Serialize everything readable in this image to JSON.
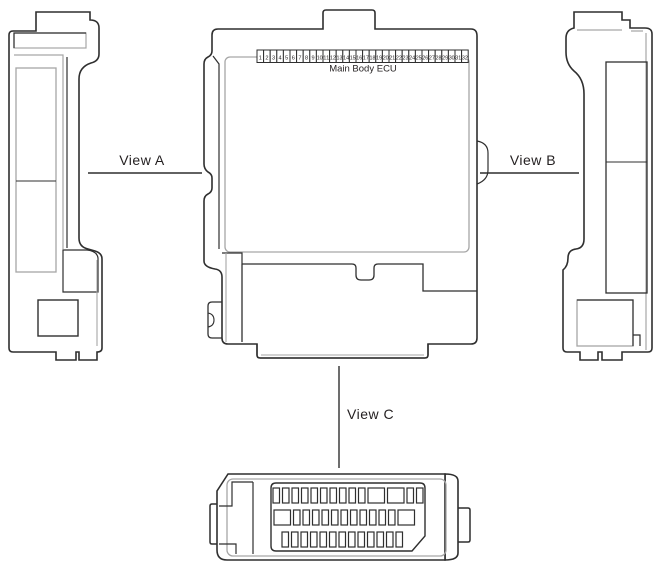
{
  "diagram": {
    "component_name": "Main Body ECU",
    "views": {
      "a": "View A",
      "b": "View B",
      "c": "View C"
    },
    "top_connector": {
      "pin_count": 32,
      "pin_numbers": [
        "1",
        "2",
        "3",
        "4",
        "5",
        "6",
        "7",
        "8",
        "9",
        "10",
        "11",
        "12",
        "13",
        "14",
        "15",
        "16",
        "17",
        "18",
        "19",
        "20",
        "21",
        "22",
        "23",
        "24",
        "25",
        "26",
        "27",
        "28",
        "29",
        "30",
        "31",
        "32"
      ]
    },
    "bottom_connector": {
      "rows": [
        {
          "slots": [
            "narrow",
            "narrow",
            "narrow",
            "narrow",
            "narrow",
            "narrow",
            "narrow",
            "narrow",
            "narrow",
            "narrow",
            "wide",
            "wide",
            "narrow",
            "narrow"
          ]
        },
        {
          "slots": [
            "wide",
            "narrow",
            "narrow",
            "narrow",
            "narrow",
            "narrow",
            "narrow",
            "narrow",
            "narrow",
            "narrow",
            "narrow",
            "narrow",
            "wide"
          ]
        },
        {
          "slots": [
            "narrow",
            "narrow",
            "narrow",
            "narrow",
            "narrow",
            "narrow",
            "narrow",
            "narrow",
            "narrow",
            "narrow",
            "narrow",
            "narrow",
            "narrow"
          ]
        }
      ]
    },
    "colors": {
      "line_dark": "#2f2f2f",
      "line_gray": "#a6a6a6",
      "text": "#231f20",
      "background": "#ffffff"
    }
  }
}
